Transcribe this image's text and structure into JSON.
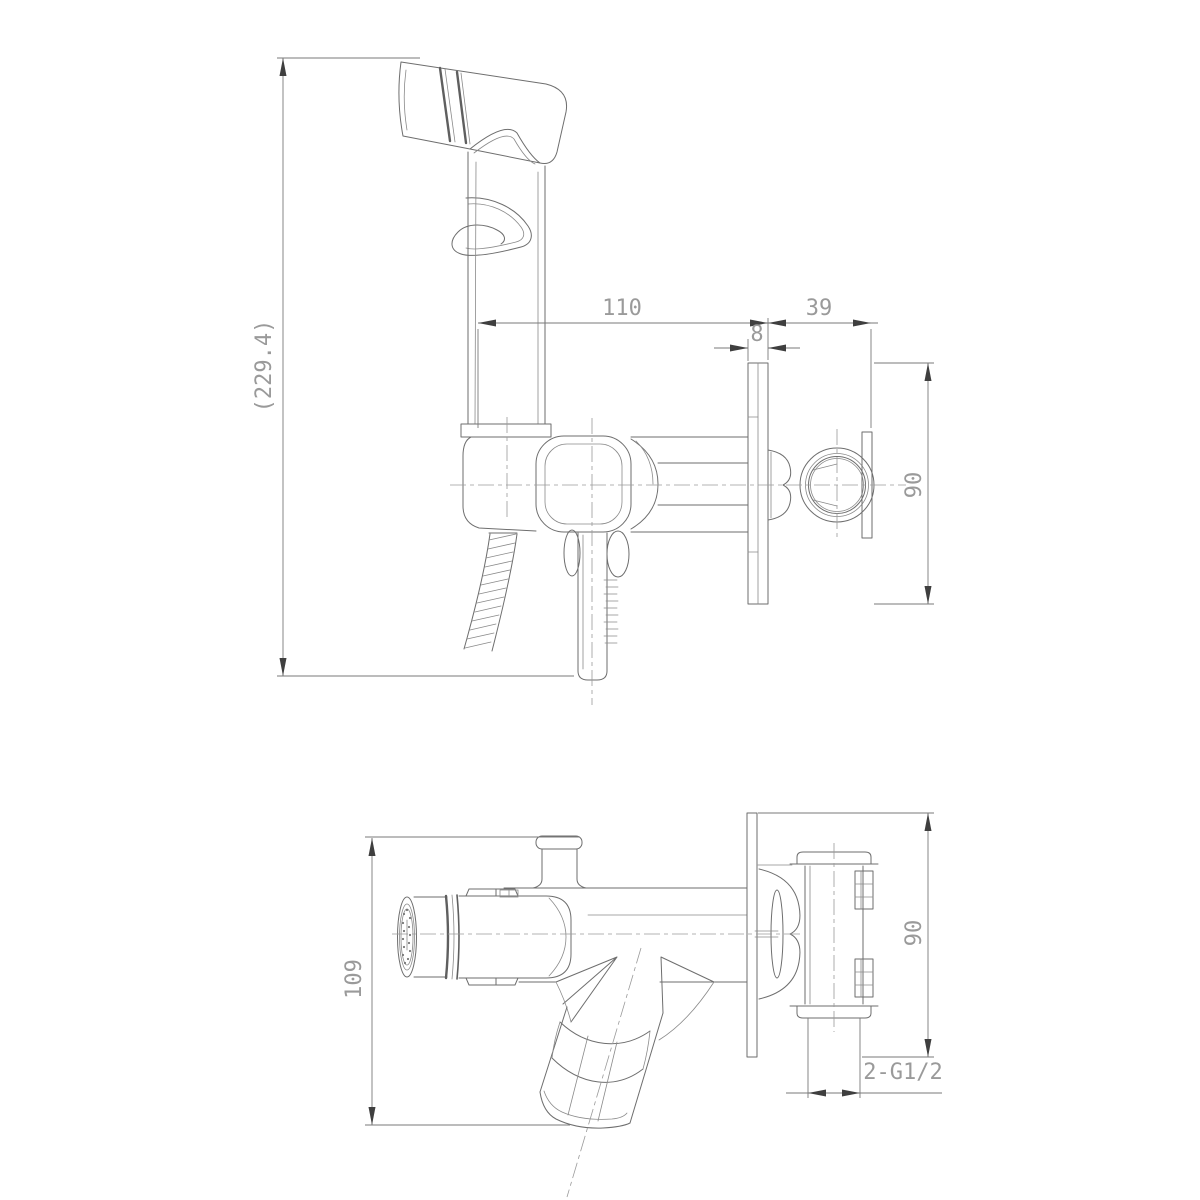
{
  "drawing": {
    "type": "technical-drawing",
    "subject": "wall-mounted hygienic hand shower (bidet sprayer) with concealed mixer",
    "views": [
      {
        "id": "side",
        "name": "side elevation with hand sprayer"
      },
      {
        "id": "plan",
        "name": "top plan view"
      }
    ],
    "side_view": {
      "dims": {
        "overall_height": "(229.4)",
        "spout_depth": "110",
        "wall_box_depth": "39",
        "plate_thickness": "8",
        "plate_size": "90"
      }
    },
    "plan_view": {
      "dims": {
        "overall_depth": "109",
        "plate_size": "90",
        "connections": "2-G1/2"
      }
    },
    "colors": {
      "line": "#6e6e6e",
      "dimension_line": "#7a7a7a",
      "dimension_text": "#9a9a9a",
      "arrow": "#3f3f3f",
      "background": "#ffffff"
    }
  }
}
